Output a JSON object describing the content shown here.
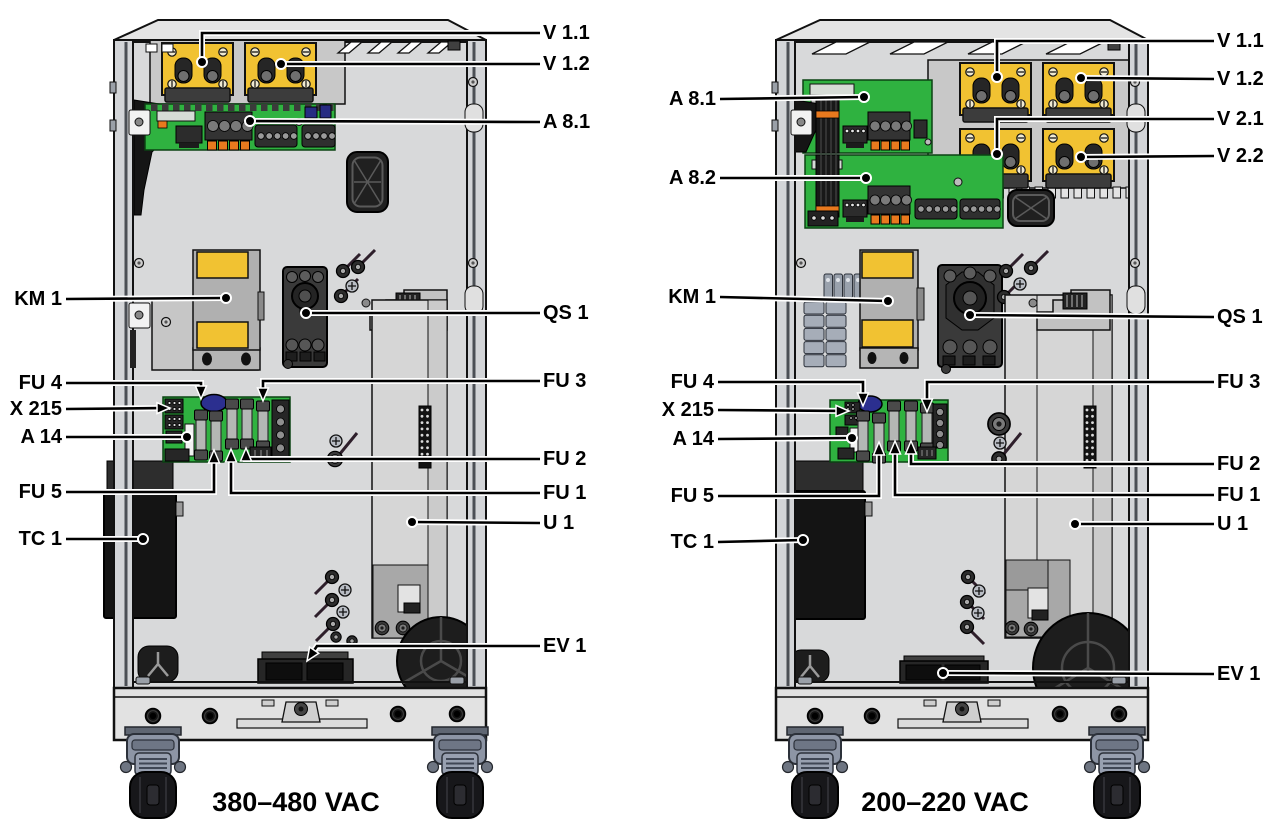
{
  "diagram_type": "cabinet-interior-callout-diagram",
  "colors": {
    "module_yellow": "#f1c232",
    "pcb_green": "#2fb240",
    "terminal_orange": "#e8791e",
    "component_navy": "#272c82",
    "cabinet_gray": "#d8d9da",
    "plate_gray": "#c8c8c8",
    "dark_component": "#2b2b2b",
    "caster_gray_blue": "#8d95a5",
    "outline": "#111111"
  },
  "figures": [
    {
      "id": "cabinet-380-480",
      "caption": "380–480 VAC",
      "callouts": [
        {
          "label": "V 1.1",
          "side": "right",
          "x": 543,
          "y": 33,
          "path": [
            [
              540,
              33
            ],
            [
              202,
              33
            ],
            [
              202,
              62
            ]
          ],
          "end": "dot"
        },
        {
          "label": "V 1.2",
          "side": "right",
          "x": 543,
          "y": 64,
          "path": [
            [
              540,
              64
            ],
            [
              281,
              64
            ]
          ],
          "end": "dot"
        },
        {
          "label": "A 8.1",
          "side": "right",
          "x": 543,
          "y": 122,
          "path": [
            [
              540,
              122
            ],
            [
              250,
              121
            ]
          ],
          "end": "dot"
        },
        {
          "label": "QS 1",
          "side": "right",
          "x": 543,
          "y": 313,
          "path": [
            [
              540,
              313
            ],
            [
              306,
              313
            ]
          ],
          "end": "dot"
        },
        {
          "label": "FU 3",
          "side": "right",
          "x": 543,
          "y": 381,
          "path": [
            [
              540,
              381
            ],
            [
              263,
              381
            ],
            [
              263,
              401
            ]
          ],
          "end": "arrow"
        },
        {
          "label": "FU 2",
          "side": "right",
          "x": 543,
          "y": 459,
          "path": [
            [
              540,
              459
            ],
            [
              246,
              459
            ],
            [
              246,
              448
            ]
          ],
          "end": "arrow"
        },
        {
          "label": "FU 1",
          "side": "right",
          "x": 543,
          "y": 493,
          "path": [
            [
              540,
              493
            ],
            [
              231,
              493
            ],
            [
              231,
              449
            ]
          ],
          "end": "arrow"
        },
        {
          "label": "U 1",
          "side": "right",
          "x": 543,
          "y": 523,
          "path": [
            [
              540,
              523
            ],
            [
              412,
              522
            ]
          ],
          "end": "dot"
        },
        {
          "label": "EV 1",
          "side": "right",
          "x": 543,
          "y": 646,
          "path": [
            [
              540,
              646
            ],
            [
              317,
              646
            ],
            [
              307,
              661
            ]
          ],
          "end": "arrow"
        },
        {
          "label": "KM 1",
          "side": "left",
          "x": 62,
          "y": 299,
          "path": [
            [
              66,
              299
            ],
            [
              226,
              298
            ]
          ],
          "end": "dot"
        },
        {
          "label": "FU 4",
          "side": "left",
          "x": 62,
          "y": 383,
          "path": [
            [
              66,
              383
            ],
            [
              201,
              383
            ],
            [
              201,
              399
            ]
          ],
          "end": "arrow"
        },
        {
          "label": "X 215",
          "side": "left",
          "x": 62,
          "y": 409,
          "path": [
            [
              66,
              409
            ],
            [
              170,
              408
            ]
          ],
          "end": "arrow"
        },
        {
          "label": "A 14",
          "side": "left",
          "x": 62,
          "y": 437,
          "path": [
            [
              66,
              437
            ],
            [
              187,
              437
            ]
          ],
          "end": "dot"
        },
        {
          "label": "FU 5",
          "side": "left",
          "x": 62,
          "y": 492,
          "path": [
            [
              66,
              492
            ],
            [
              214,
              492
            ],
            [
              214,
              450
            ]
          ],
          "end": "arrow"
        },
        {
          "label": "TC 1",
          "side": "left",
          "x": 62,
          "y": 539,
          "path": [
            [
              66,
              539
            ],
            [
              143,
              539
            ]
          ],
          "end": "dot"
        }
      ]
    },
    {
      "id": "cabinet-200-220",
      "caption": "200–220 VAC",
      "callouts": [
        {
          "label": "V 1.1",
          "side": "right",
          "x": 1217,
          "y": 41,
          "path": [
            [
              1214,
              41
            ],
            [
              997,
              41
            ],
            [
              997,
              77
            ]
          ],
          "end": "dot"
        },
        {
          "label": "V 1.2",
          "side": "right",
          "x": 1217,
          "y": 79,
          "path": [
            [
              1214,
              79
            ],
            [
              1081,
              78
            ]
          ],
          "end": "dot"
        },
        {
          "label": "V 2.1",
          "side": "right",
          "x": 1217,
          "y": 119,
          "path": [
            [
              1214,
              119
            ],
            [
              997,
              119
            ],
            [
              997,
              154
            ]
          ],
          "end": "dot"
        },
        {
          "label": "V 2.2",
          "side": "right",
          "x": 1217,
          "y": 156,
          "path": [
            [
              1214,
              156
            ],
            [
              1081,
              157
            ]
          ],
          "end": "dot"
        },
        {
          "label": "QS 1",
          "side": "right",
          "x": 1217,
          "y": 317,
          "path": [
            [
              1214,
              317
            ],
            [
              970,
              315
            ]
          ],
          "end": "dot"
        },
        {
          "label": "FU 3",
          "side": "right",
          "x": 1217,
          "y": 382,
          "path": [
            [
              1214,
              382
            ],
            [
              927,
              382
            ],
            [
              927,
              412
            ]
          ],
          "end": "arrow"
        },
        {
          "label": "FU 2",
          "side": "right",
          "x": 1217,
          "y": 464,
          "path": [
            [
              1214,
              464
            ],
            [
              911,
              464
            ],
            [
              911,
              441
            ]
          ],
          "end": "arrow"
        },
        {
          "label": "FU 1",
          "side": "right",
          "x": 1217,
          "y": 495,
          "path": [
            [
              1214,
              495
            ],
            [
              895,
              495
            ],
            [
              895,
              441
            ]
          ],
          "end": "arrow"
        },
        {
          "label": "U 1",
          "side": "right",
          "x": 1217,
          "y": 524,
          "path": [
            [
              1214,
              524
            ],
            [
              1075,
              524
            ]
          ],
          "end": "dot"
        },
        {
          "label": "EV 1",
          "side": "right",
          "x": 1217,
          "y": 674,
          "path": [
            [
              1214,
              674
            ],
            [
              943,
              673
            ]
          ],
          "end": "dot"
        },
        {
          "label": "A 8.1",
          "side": "left",
          "x": 716,
          "y": 99,
          "path": [
            [
              720,
              99
            ],
            [
              864,
              97
            ]
          ],
          "end": "dot"
        },
        {
          "label": "A 8.2",
          "side": "left",
          "x": 716,
          "y": 178,
          "path": [
            [
              720,
              178
            ],
            [
              866,
              178
            ]
          ],
          "end": "dot"
        },
        {
          "label": "KM 1",
          "side": "left",
          "x": 716,
          "y": 297,
          "path": [
            [
              720,
              297
            ],
            [
              888,
              301
            ]
          ],
          "end": "dot"
        },
        {
          "label": "FU 4",
          "side": "left",
          "x": 714,
          "y": 382,
          "path": [
            [
              718,
              382
            ],
            [
              863,
              382
            ],
            [
              863,
              406
            ]
          ],
          "end": "arrow"
        },
        {
          "label": "X 215",
          "side": "left",
          "x": 714,
          "y": 410,
          "path": [
            [
              718,
              410
            ],
            [
              849,
              411
            ]
          ],
          "end": "arrow"
        },
        {
          "label": "A 14",
          "side": "left",
          "x": 714,
          "y": 439,
          "path": [
            [
              718,
              439
            ],
            [
              852,
              438
            ]
          ],
          "end": "dot"
        },
        {
          "label": "FU 5",
          "side": "left",
          "x": 714,
          "y": 496,
          "path": [
            [
              718,
              496
            ],
            [
              879,
              496
            ],
            [
              879,
              442
            ]
          ],
          "end": "arrow"
        },
        {
          "label": "TC 1",
          "side": "left",
          "x": 714,
          "y": 542,
          "path": [
            [
              718,
              542
            ],
            [
              803,
              540
            ]
          ],
          "end": "dot"
        }
      ]
    }
  ]
}
